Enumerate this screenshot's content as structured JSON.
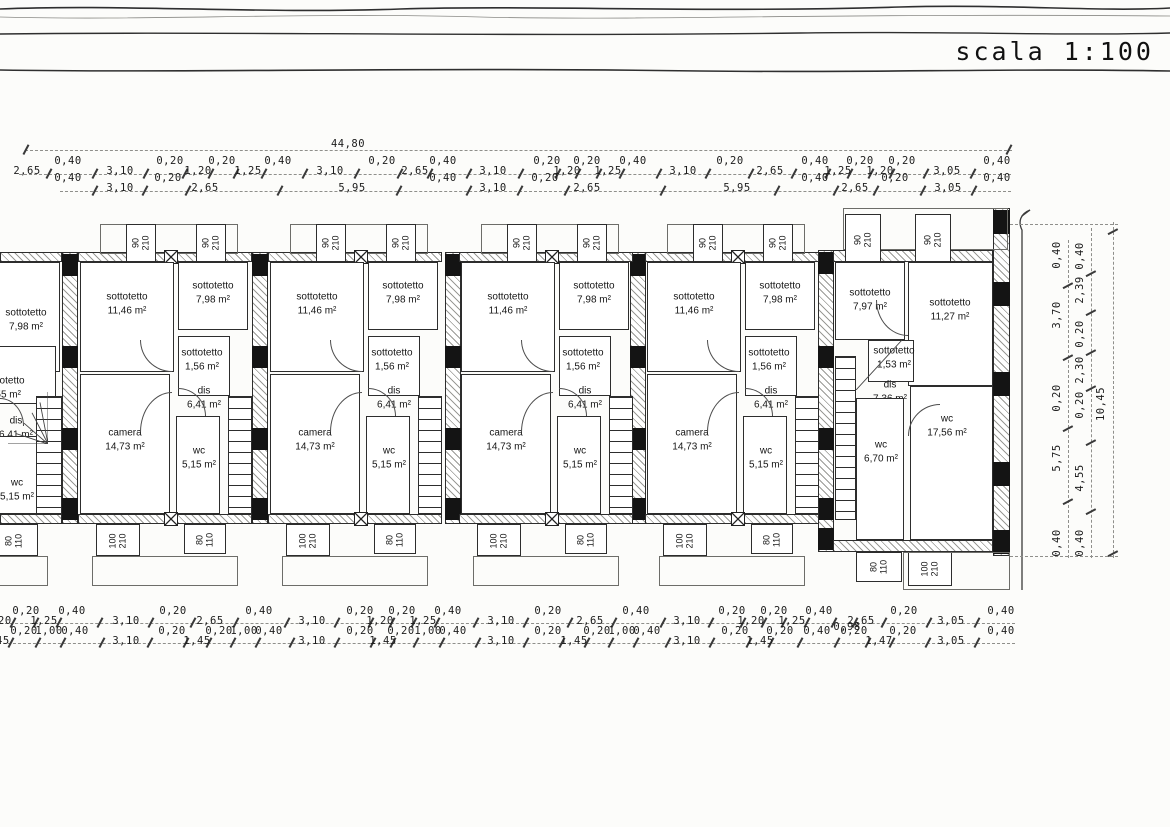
{
  "scale_label": "scala 1:100",
  "dimensions": {
    "top_total": "44,80",
    "right_total": "10,45",
    "top_row1": [
      "2,65",
      "0,40",
      "3,10",
      "0,20",
      "1,20",
      "0,20",
      "1,25",
      "0,40",
      "3,10",
      "0,20",
      "2,65",
      "0,40",
      "3,10",
      "0,20",
      "1,20",
      "0,20",
      "1,25",
      "0,40",
      "3,10",
      "0,20",
      "2,65",
      "0,40",
      "1,25",
      "0,20",
      "1,20",
      "0,20",
      "3,05",
      "0,40"
    ],
    "top_row2": [
      "0,40",
      "3,10",
      "0,20",
      "2,65",
      "5,95",
      "0,40",
      "3,10",
      "0,20",
      "2,65",
      "5,95",
      "0,40",
      "2,65",
      "0,20",
      "3,05",
      "0,40"
    ],
    "bottom_row1": [
      "0,20",
      "0,20",
      "1,25",
      "0,40",
      "3,10",
      "0,20",
      "2,65",
      "0,40",
      "3,10",
      "0,20",
      "1,20",
      "0,20",
      "1,25",
      "0,40",
      "3,10",
      "0,20",
      "2,65",
      "0,40",
      "3,10",
      "0,20",
      "1,20",
      "0,20",
      "1,25",
      "0,40",
      "0,98",
      "2,65",
      "0,20",
      "3,05",
      "0,40"
    ],
    "bottom_row2": [
      "1,45",
      "0,20",
      "1,00",
      "0,40",
      "3,10",
      "0,20",
      "1,45",
      "0,20",
      "1,00",
      "0,40",
      "3,10",
      "0,20",
      "1,45",
      "0,20",
      "1,00",
      "0,40",
      "3,10",
      "0,20",
      "1,45",
      "0,20",
      "1,00",
      "0,40",
      "3,10",
      "0,20",
      "1,45",
      "0,20",
      "0,40",
      "0,20",
      "1,47",
      "0,20",
      "3,05",
      "0,40"
    ],
    "right_col1": [
      "0,40",
      "3,70",
      "0,20",
      "5,75",
      "0,40"
    ],
    "right_col2": [
      "0,40",
      "2,39",
      "0,20",
      "2,30",
      "0,20",
      "4,55",
      "0,40"
    ]
  },
  "window_labels": {
    "dormer": [
      "90",
      "210"
    ],
    "door_large": [
      "100",
      "210"
    ],
    "window_small": [
      "80",
      "110"
    ]
  },
  "units": [
    {
      "id": "A",
      "type": "partial-left",
      "rooms": [
        {
          "name": "sottotetto",
          "area": "7,98 m²"
        },
        {
          "name": "sottotetto",
          "area": "1,55 m²"
        },
        {
          "name": "dis",
          "area": "6,41 m²"
        },
        {
          "name": "wc",
          "area": "5,15 m²"
        }
      ]
    },
    {
      "id": "B",
      "type": "standard",
      "rooms": [
        {
          "name": "sottotetto",
          "area": "11,46 m²"
        },
        {
          "name": "sottotetto",
          "area": "7,98 m²"
        },
        {
          "name": "sottotetto",
          "area": "1,56 m²"
        },
        {
          "name": "dis",
          "area": "6,41 m²"
        },
        {
          "name": "camera",
          "area": "14,73 m²"
        },
        {
          "name": "wc",
          "area": "5,15 m²"
        }
      ]
    },
    {
      "id": "C",
      "type": "standard",
      "rooms": [
        {
          "name": "sottotetto",
          "area": "11,46 m²"
        },
        {
          "name": "sottotetto",
          "area": "7,98 m²"
        },
        {
          "name": "sottotetto",
          "area": "1,56 m²"
        },
        {
          "name": "dis",
          "area": "6,41 m²"
        },
        {
          "name": "camera",
          "area": "14,73 m²"
        },
        {
          "name": "wc",
          "area": "5,15 m²"
        }
      ]
    },
    {
      "id": "D",
      "type": "standard",
      "rooms": [
        {
          "name": "sottotetto",
          "area": "11,46 m²"
        },
        {
          "name": "sottotetto",
          "area": "7,98 m²"
        },
        {
          "name": "sottotetto",
          "area": "1,56 m²"
        },
        {
          "name": "dis",
          "area": "6,41 m²"
        },
        {
          "name": "camera",
          "area": "14,73 m²"
        },
        {
          "name": "wc",
          "area": "5,15 m²"
        }
      ]
    },
    {
      "id": "E",
      "type": "standard",
      "rooms": [
        {
          "name": "sottotetto",
          "area": "11,46 m²"
        },
        {
          "name": "sottotetto",
          "area": "7,98 m²"
        },
        {
          "name": "sottotetto",
          "area": "1,56 m²"
        },
        {
          "name": "dis",
          "area": "6,41 m²"
        },
        {
          "name": "camera",
          "area": "14,73 m²"
        },
        {
          "name": "wc",
          "area": "5,15 m²"
        }
      ]
    },
    {
      "id": "F",
      "type": "end-right",
      "rooms": [
        {
          "name": "sottotetto",
          "area": "7,97 m²"
        },
        {
          "name": "sottotetto",
          "area": "11,27 m²"
        },
        {
          "name": "sottotetto",
          "area": "1,53 m²"
        },
        {
          "name": "dis",
          "area": "7,36 m²"
        },
        {
          "name": "wc",
          "area": "6,70 m²"
        },
        {
          "name": "wc",
          "area": "17,56 m²"
        }
      ]
    }
  ]
}
